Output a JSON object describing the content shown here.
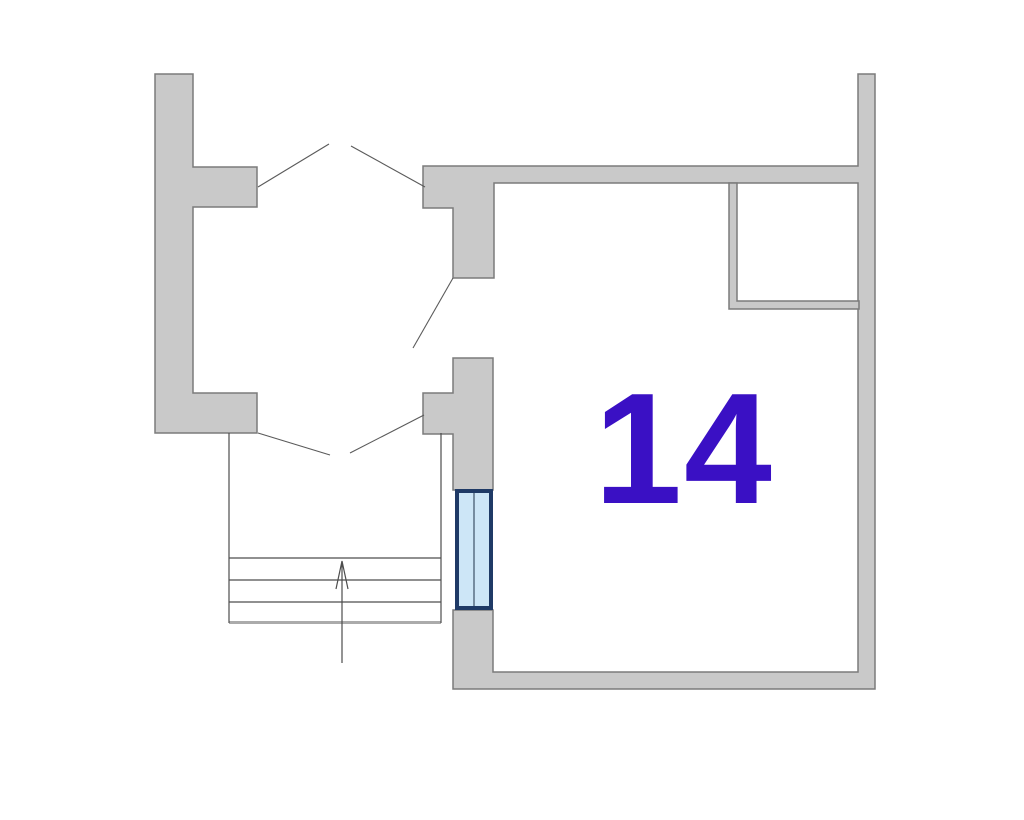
{
  "room": {
    "number": "14",
    "label_color": "#3A10C4"
  },
  "colors": {
    "background": "#FFFFFF",
    "wall_fill": "#C9C9C9",
    "wall_outline": "#7B7B7B",
    "thin_line": "#4D4D4D",
    "stairs_base": "#ABABAB",
    "window_frame": "#1F3A66",
    "window_glass": "#CDE6F7",
    "window_divider": "#60758A"
  },
  "symbols": {
    "door_swing_top": "double-door-swing-open",
    "door_swing_bottom": "double-door-swing-open",
    "door_swing_room": "single-door-swing-open",
    "staircase": "stairs-with-up-direction-arrow",
    "window": "double-pane-window",
    "closet": "thin-wall-closet"
  }
}
